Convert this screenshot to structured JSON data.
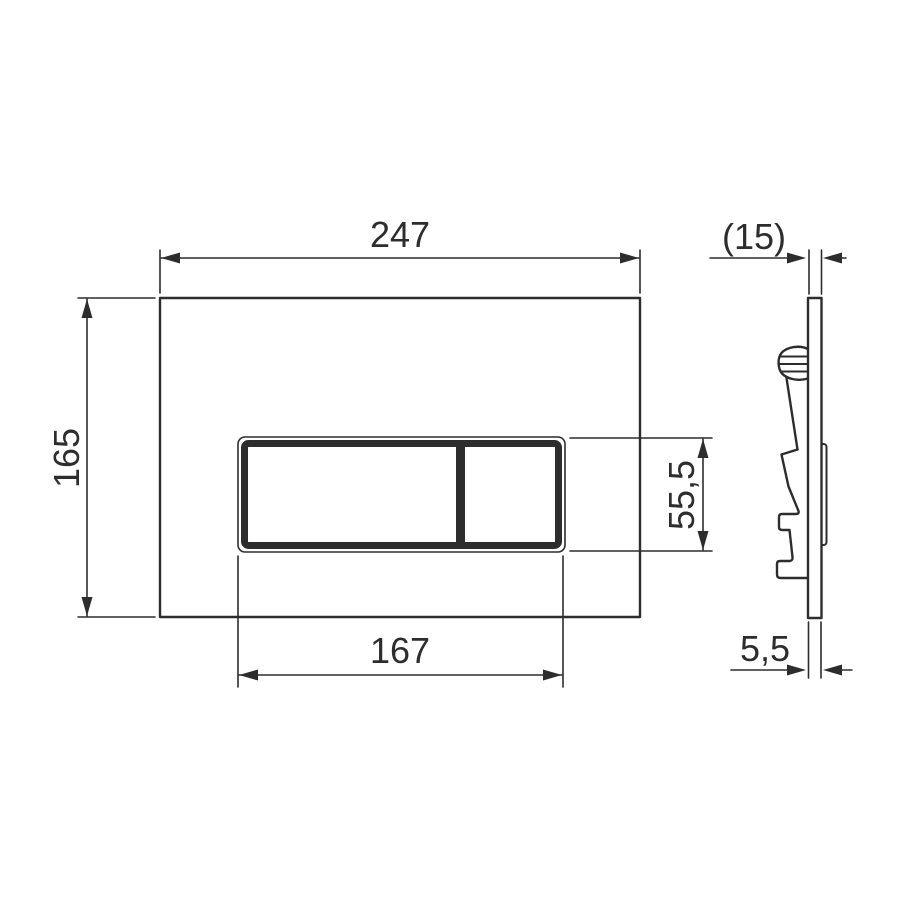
{
  "drawing": {
    "title": "flush-plate-dimension-drawing",
    "colors": {
      "line": "#2d2d2d",
      "background": "#ffffff"
    },
    "views": {
      "front": {
        "name": "front view"
      },
      "side": {
        "name": "side profile view"
      }
    },
    "dimensions": {
      "plate_width": {
        "label": "247",
        "value": 247
      },
      "plate_height": {
        "label": "165",
        "value": 165
      },
      "button_area_width": {
        "label": "167",
        "value": 167
      },
      "button_area_height": {
        "label": "55,5",
        "value": 55.5
      },
      "overall_depth": {
        "label": "(15)",
        "value": 15
      },
      "plate_thickness": {
        "label": "5,5",
        "value": 5.5
      }
    }
  }
}
